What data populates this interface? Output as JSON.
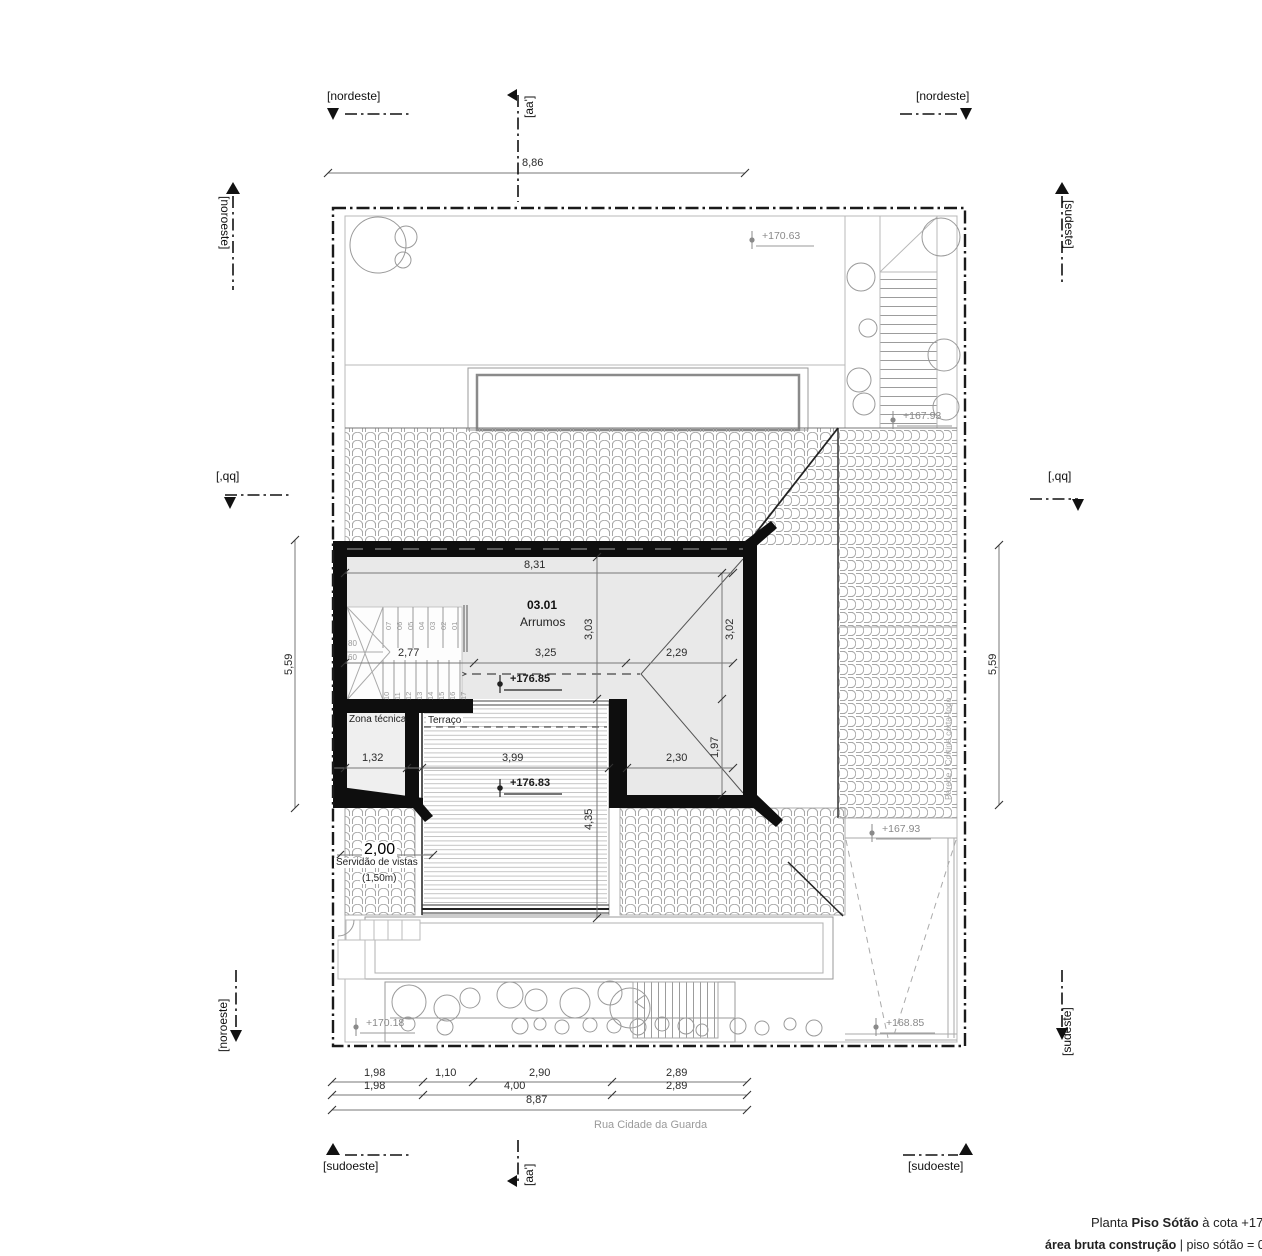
{
  "title": {
    "l1a": "Planta ",
    "l1b": "Piso Sótão",
    "l1c": " à cota +17",
    "l2a": "área bruta construção",
    "l2b": " | piso sótão = 03"
  },
  "markers": [
    {
      "n": "section-marker-nordeste-left",
      "t": "[nordeste]",
      "x": 327,
      "y": 90
    },
    {
      "n": "section-marker-nordeste-right",
      "t": "[nordeste]",
      "x": 916,
      "y": 90
    },
    {
      "n": "section-marker-aa-top",
      "t": "[aa']",
      "x": 523,
      "y": 118,
      "r": -90
    },
    {
      "n": "section-marker-aa-bottom",
      "t": "[aa']",
      "x": 523,
      "y": 1186,
      "r": -90
    },
    {
      "n": "section-marker-noroeste-top",
      "t": "[noroeste]",
      "x": 231,
      "y": 196,
      "r": 90
    },
    {
      "n": "section-marker-noroeste-bottom",
      "t": "[noroeste]",
      "x": 217,
      "y": 1052,
      "r": -90
    },
    {
      "n": "section-marker-sudeste-top",
      "t": "[sudeste]",
      "x": 1075,
      "y": 200,
      "r": 90
    },
    {
      "n": "section-marker-sudeste-bottom",
      "t": "[sudeste]",
      "x": 1061,
      "y": 1056,
      "r": -90
    },
    {
      "n": "section-marker-qq-left",
      "t": "[,qq]",
      "x": 216,
      "y": 470
    },
    {
      "n": "section-marker-qq-right",
      "t": "[,qq]",
      "x": 1048,
      "y": 470
    },
    {
      "n": "section-marker-sudoeste-left",
      "t": "[sudoeste]",
      "x": 323,
      "y": 1160
    },
    {
      "n": "section-marker-sudoeste-right",
      "t": "[sudoeste]",
      "x": 908,
      "y": 1160
    }
  ],
  "dims": [
    {
      "n": "dim-site-top",
      "t": "8,86",
      "x": 522,
      "y": 158
    },
    {
      "n": "dim-side-left",
      "t": "5,59",
      "x": 284,
      "y": 675,
      "r": -90
    },
    {
      "n": "dim-side-right",
      "t": "5,59",
      "x": 988,
      "y": 675,
      "r": -90
    },
    {
      "n": "dim-room-width",
      "t": "8,31",
      "x": 524,
      "y": 560
    },
    {
      "n": "dim-room-depth",
      "t": "3,03",
      "x": 584,
      "y": 640,
      "r": -90
    },
    {
      "n": "dim-room-depth-right",
      "t": "3,02",
      "x": 725,
      "y": 640,
      "r": -90
    },
    {
      "n": "dim-stair",
      "t": "2,77",
      "x": 398,
      "y": 648
    },
    {
      "n": "dim-room-mid",
      "t": "3,25",
      "x": 535,
      "y": 648
    },
    {
      "n": "dim-room-right",
      "t": "2,29",
      "x": 666,
      "y": 648
    },
    {
      "n": "dim-zona",
      "t": "1,32",
      "x": 362,
      "y": 753
    },
    {
      "n": "dim-terrace-width",
      "t": "3,99",
      "x": 502,
      "y": 753
    },
    {
      "n": "dim-wing",
      "t": "2,30",
      "x": 666,
      "y": 753
    },
    {
      "n": "dim-wing-depth",
      "t": "1,97",
      "x": 710,
      "y": 758,
      "r": -90
    },
    {
      "n": "dim-terrace-depth",
      "t": "4,35",
      "x": 584,
      "y": 830,
      "r": -90
    },
    {
      "n": "dim-servidao",
      "t": "2,00",
      "x": 362,
      "y": 842,
      "c": "wbg"
    },
    {
      "n": "dim-bottom-a1",
      "t": "1,98",
      "x": 364,
      "y": 1068
    },
    {
      "n": "dim-bottom-a2",
      "t": "1,10",
      "x": 435,
      "y": 1068
    },
    {
      "n": "dim-bottom-a3",
      "t": "2,90",
      "x": 529,
      "y": 1068
    },
    {
      "n": "dim-bottom-a4",
      "t": "2,89",
      "x": 666,
      "y": 1068
    },
    {
      "n": "dim-bottom-b1",
      "t": "1,98",
      "x": 364,
      "y": 1081
    },
    {
      "n": "dim-bottom-b2",
      "t": "4,00",
      "x": 504,
      "y": 1081
    },
    {
      "n": "dim-bottom-b3",
      "t": "2,89",
      "x": 666,
      "y": 1081
    },
    {
      "n": "dim-bottom-total",
      "t": "8,87",
      "x": 526,
      "y": 1095
    }
  ],
  "levels": [
    {
      "n": "level-marker",
      "t": "+170.63",
      "x": 762,
      "y": 231,
      "c": "lvl"
    },
    {
      "n": "level-marker",
      "t": "+167.93",
      "x": 903,
      "y": 411,
      "c": "lvl"
    },
    {
      "n": "level-marker",
      "t": "+167.93",
      "x": 882,
      "y": 824,
      "c": "lvl"
    },
    {
      "n": "level-marker",
      "t": "+168.85",
      "x": 886,
      "y": 1018,
      "c": "lvl"
    },
    {
      "n": "level-marker",
      "t": "+170.18",
      "x": 366,
      "y": 1018,
      "c": "lvl"
    },
    {
      "n": "level-marker",
      "t": "+176.85",
      "x": 510,
      "y": 674,
      "c": "lvld"
    },
    {
      "n": "level-marker",
      "t": "+176.83",
      "x": 510,
      "y": 778,
      "c": "lvld"
    }
  ],
  "texts": [
    {
      "n": "room-number",
      "t": "03.01",
      "x": 527,
      "y": 599,
      "c": "rn"
    },
    {
      "n": "room-name",
      "t": "Arrumos",
      "x": 520,
      "y": 616,
      "c": "rm"
    },
    {
      "n": "room-zona-tecnica",
      "t": "Zona técnica",
      "x": 349,
      "y": 715,
      "c": "sm"
    },
    {
      "n": "room-terraco",
      "t": "Terraço",
      "x": 426,
      "y": 716,
      "c": "sm wbg"
    },
    {
      "n": "servidao-line1",
      "t": "Servidão de vistas",
      "x": 334,
      "y": 858,
      "c": "sm wbg"
    },
    {
      "n": "servidao-line2",
      "t": "(1,50m)",
      "x": 360,
      "y": 874,
      "c": "sm wbg"
    },
    {
      "n": "street-name",
      "t": "Rua Cidade da Guarda",
      "x": 594,
      "y": 1120,
      "c": "street"
    },
    {
      "n": "firewall-note",
      "t": "Parede | Cortina corta-fogo",
      "x": 944,
      "y": 800,
      "r": -90,
      "c": "tiny"
    },
    {
      "n": "stair-width-80",
      "t": "80",
      "x": 348,
      "y": 640,
      "c": "stn2"
    },
    {
      "n": "stair-width-60",
      "t": "60",
      "x": 348,
      "y": 654,
      "c": "stn2"
    }
  ],
  "stnums": [
    {
      "n": "stair-step",
      "t": "07",
      "x": 385,
      "y": 630,
      "r": -90,
      "c": "stn"
    },
    {
      "n": "stair-step",
      "t": "06",
      "x": 396,
      "y": 630,
      "r": -90,
      "c": "stn"
    },
    {
      "n": "stair-step",
      "t": "05",
      "x": 407,
      "y": 630,
      "r": -90,
      "c": "stn"
    },
    {
      "n": "stair-step",
      "t": "04",
      "x": 418,
      "y": 630,
      "r": -90,
      "c": "stn"
    },
    {
      "n": "stair-step",
      "t": "03",
      "x": 429,
      "y": 630,
      "r": -90,
      "c": "stn"
    },
    {
      "n": "stair-step",
      "t": "02",
      "x": 440,
      "y": 630,
      "r": -90,
      "c": "stn"
    },
    {
      "n": "stair-step",
      "t": "01",
      "x": 451,
      "y": 630,
      "r": -90,
      "c": "stn"
    },
    {
      "n": "stair-step",
      "t": "10",
      "x": 383,
      "y": 700,
      "r": -90,
      "c": "stn"
    },
    {
      "n": "stair-step",
      "t": "11",
      "x": 394,
      "y": 700,
      "r": -90,
      "c": "stn"
    },
    {
      "n": "stair-step",
      "t": "12",
      "x": 405,
      "y": 700,
      "r": -90,
      "c": "stn"
    },
    {
      "n": "stair-step",
      "t": "13",
      "x": 416,
      "y": 700,
      "r": -90,
      "c": "stn"
    },
    {
      "n": "stair-step",
      "t": "14",
      "x": 427,
      "y": 700,
      "r": -90,
      "c": "stn"
    },
    {
      "n": "stair-step",
      "t": "15",
      "x": 438,
      "y": 700,
      "r": -90,
      "c": "stn"
    },
    {
      "n": "stair-step",
      "t": "16",
      "x": 449,
      "y": 700,
      "r": -90,
      "c": "stn"
    },
    {
      "n": "stair-step",
      "t": "17",
      "x": 460,
      "y": 700,
      "r": -90,
      "c": "stn"
    }
  ],
  "colors": {
    "wall": "#0e0e0e",
    "floor": "#e9e9e9",
    "hatch": "#a8a8a8",
    "site": "#b8b8b8",
    "dimline": "#777777",
    "level": "#8a8a8a",
    "boundary": "#1a1a1a"
  }
}
